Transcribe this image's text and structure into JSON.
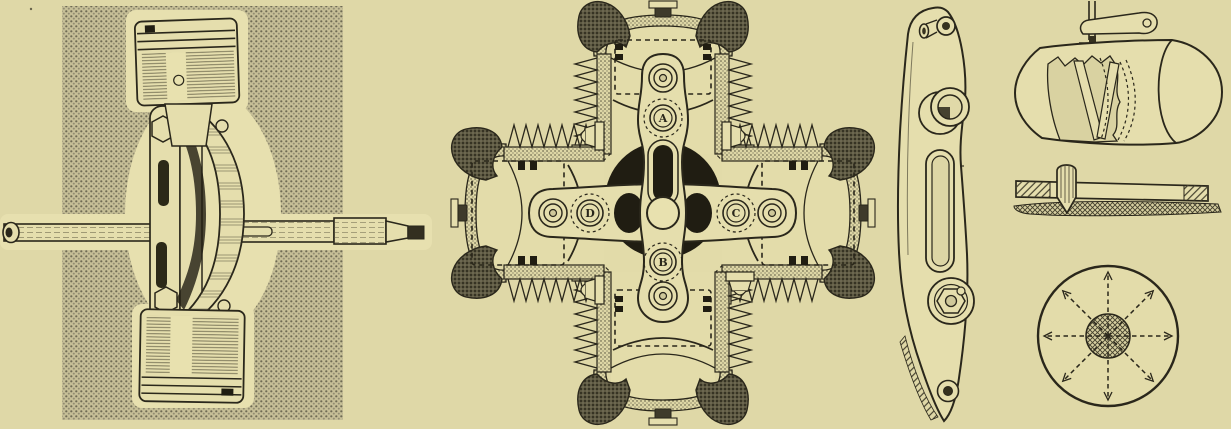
{
  "palette": {
    "paper": "#dfd8a7",
    "ink": "#2a271b",
    "part_fill": "#e5dead",
    "halftone_background": "#c6bf97",
    "black_fill": "#201d12"
  },
  "figures": {
    "photo": {
      "name": "piston-yoke-and-crankshaft-photograph"
    },
    "engine": {
      "name": "four-cylinder-x-engine-cross-section",
      "labels": {
        "a": "A",
        "b": "B",
        "c": "C",
        "d": "D"
      }
    },
    "link": {
      "name": "slotted-yoke-link-side-view"
    },
    "cutaway": {
      "name": "cylinder-cutaway-with-rocker-lever"
    },
    "rodpin": {
      "name": "rod-and-pin-through-wall-detail"
    },
    "disc": {
      "name": "disc-with-eight-dashed-radial-spokes"
    }
  }
}
